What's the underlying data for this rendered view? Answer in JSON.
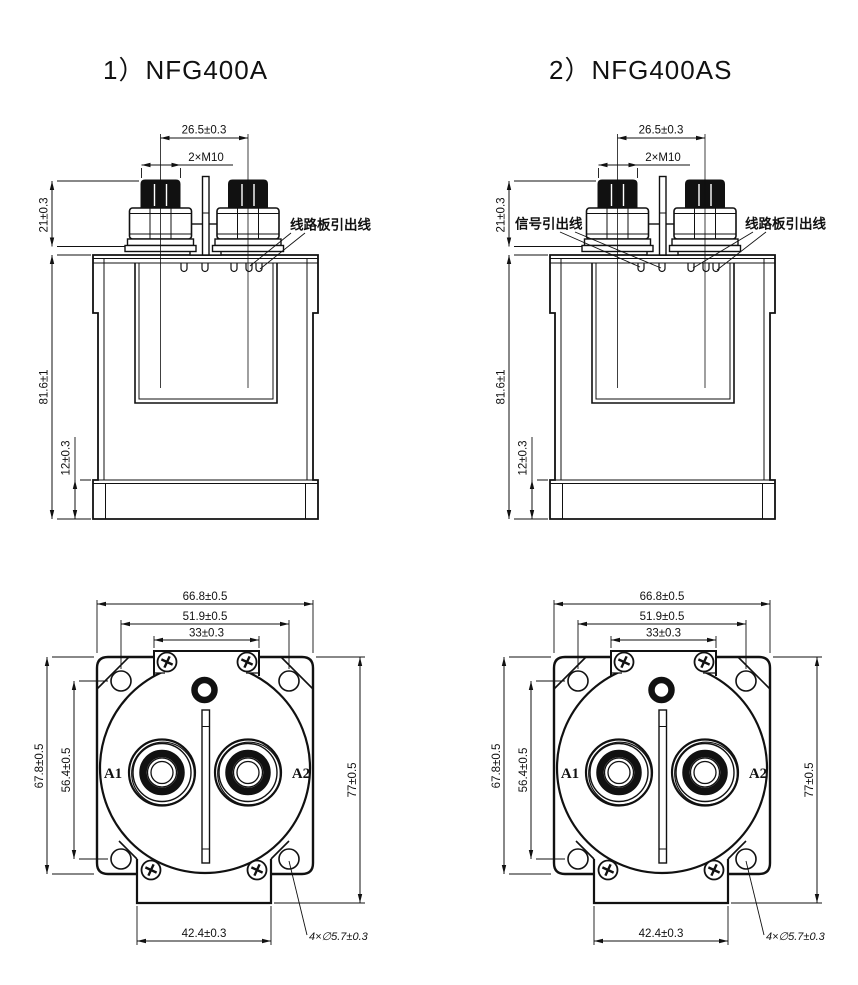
{
  "titles": {
    "left": "1）NFG400A",
    "right": "2）NFG400AS"
  },
  "front_dims": {
    "terminal_pitch": "26.5±0.3",
    "thread": "2×M10",
    "stud_height": "21±0.3",
    "body_height": "81.6±1",
    "flange_height": "12±0.3"
  },
  "bottom_dims": {
    "width": "66.8±0.5",
    "hole_span_x": "51.9±0.5",
    "tab_top_width": "33±0.3",
    "height": "67.8±0.5",
    "hole_span_y": "56.4±0.5",
    "overall_height": "77±0.5",
    "tab_bottom_width": "42.4±0.3",
    "mount_holes": "4×∅5.7±0.3"
  },
  "labels": {
    "pcb_leads": "线路板引出线",
    "signal_leads": "信号引出线",
    "terminal_a1": "A1",
    "terminal_a2": "A2"
  },
  "colors": {
    "line": "#111111",
    "background": "#ffffff"
  }
}
